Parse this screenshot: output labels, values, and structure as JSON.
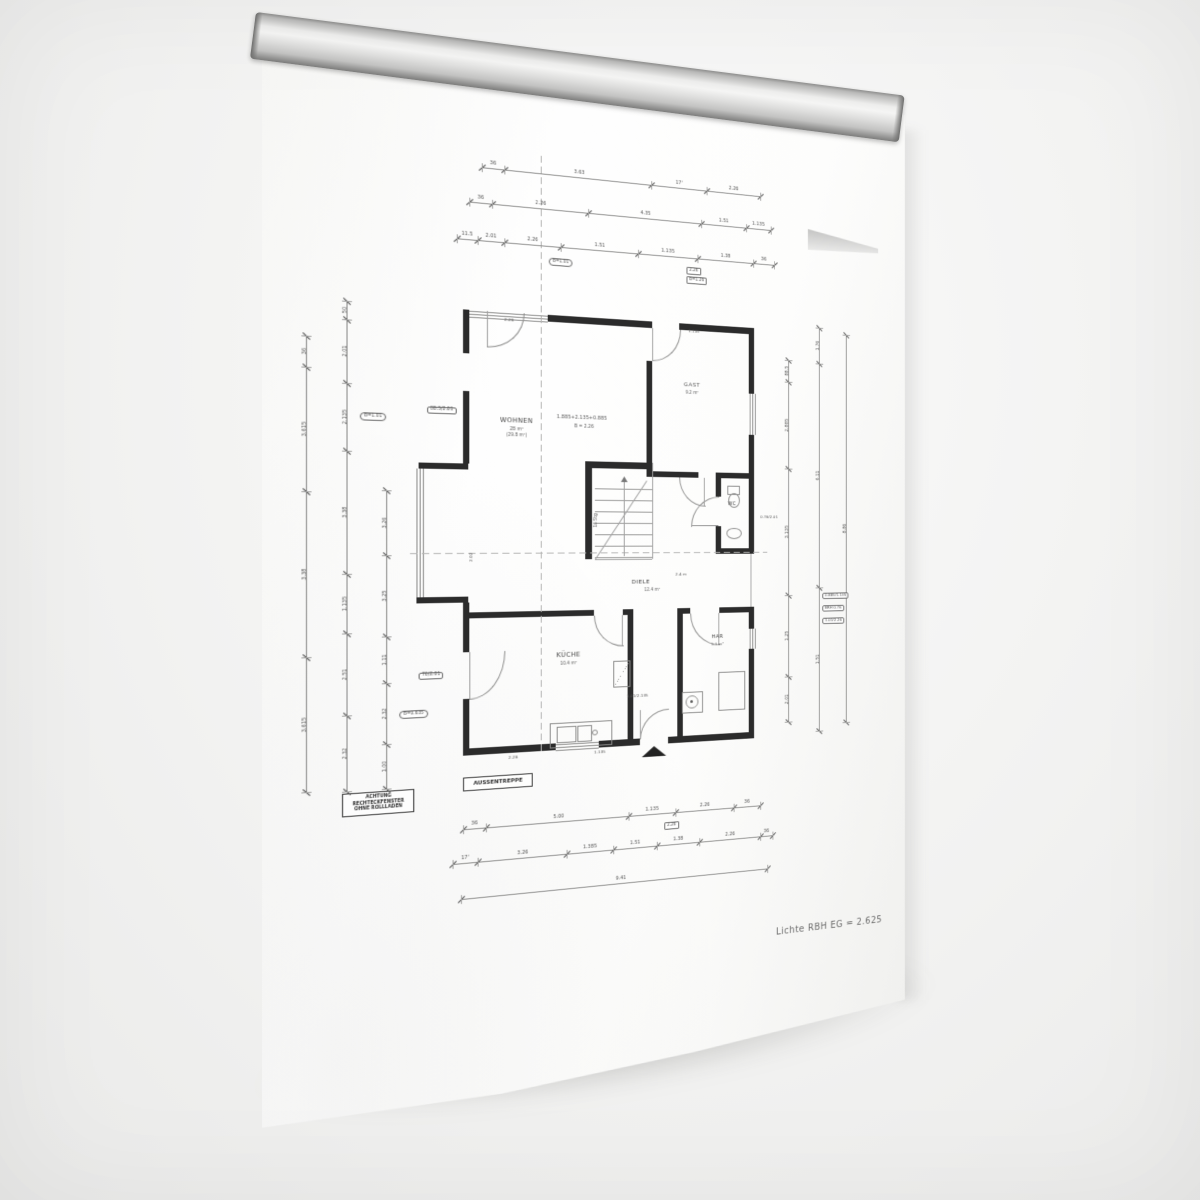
{
  "scene": {
    "description": "photo of architectural ground-floor plan sheet hanging on a wall rail",
    "background_color": "#f2f2f1",
    "paper_color": "#fdfdfc",
    "rail_color": "#d9d9d8",
    "ink_color": "#2b2b2b"
  },
  "rooms": {
    "wohnen": {
      "name": "WOHNEN",
      "area": "28 m²",
      "area2": "(29.8 m²)"
    },
    "gast": {
      "name": "GAST",
      "area": "9.2 m²"
    },
    "wc": {
      "name": "WC"
    },
    "diele": {
      "name": "DIELE",
      "area": "12.4 m²"
    },
    "kueche": {
      "name": "KÜCHE",
      "area": "10.4 m²"
    },
    "har": {
      "name": "HAR",
      "area": "5.1 m²"
    }
  },
  "notes": {
    "warning": [
      "ACHTUNG",
      "RECHTECKFENSTER",
      "OHNE ROLLLADEN"
    ],
    "box_label": "AUSSENTREPPE",
    "bottom_right": "Lichte RBH EG = 2.625"
  },
  "chains": [
    {
      "o": "h",
      "x": 38,
      "y": 148,
      "segs": [
        [
          22,
          "36"
        ],
        [
          150,
          "3.63"
        ],
        [
          60,
          "17'"
        ],
        [
          60,
          "2.26"
        ]
      ]
    },
    {
      "o": "h",
      "x": 26,
      "y": 184,
      "segs": [
        [
          22,
          "36"
        ],
        [
          96,
          "2.26"
        ],
        [
          120,
          "4.35"
        ],
        [
          50,
          "1.51"
        ],
        [
          28,
          "1.135"
        ]
      ]
    },
    {
      "o": "h",
      "x": 14,
      "y": 222,
      "segs": [
        [
          20,
          "11.5"
        ],
        [
          26,
          "2.01"
        ],
        [
          56,
          "2.26"
        ],
        [
          80,
          "1.51"
        ],
        [
          64,
          "1.135"
        ],
        [
          62,
          "1.38"
        ],
        [
          24,
          "36"
        ]
      ],
      "tags": [
        {
          "at": 102,
          "dy": 12,
          "t": "B=1.01",
          "oval": true
        },
        {
          "at": 246,
          "dy": 10,
          "t": "2.26",
          "box": true
        },
        {
          "at": 246,
          "dy": 20,
          "t": "B=1.26",
          "box": true
        }
      ]
    },
    {
      "o": "h",
      "x": 20,
      "y": 816,
      "segs": [
        [
          22,
          "36"
        ],
        [
          144,
          "5.00"
        ],
        [
          50,
          "1.135"
        ],
        [
          64,
          "2.26"
        ],
        [
          30,
          "36"
        ]
      ],
      "tags": [
        {
          "at": 216,
          "dy": 10,
          "t": "2.26",
          "box": true
        }
      ]
    },
    {
      "o": "h",
      "x": 10,
      "y": 850,
      "segs": [
        [
          24,
          "17'"
        ],
        [
          88,
          "3.26"
        ],
        [
          48,
          "1.385"
        ],
        [
          46,
          "1.51"
        ],
        [
          46,
          "1.38"
        ],
        [
          68,
          "2.26"
        ],
        [
          14,
          "36"
        ]
      ]
    },
    {
      "o": "h",
      "x": 18,
      "y": 886,
      "segs": [
        [
          320,
          "9.41"
        ]
      ]
    },
    {
      "o": "v",
      "x": -124,
      "y": 328,
      "segs": [
        [
          30,
          "36"
        ],
        [
          120,
          "3.615"
        ],
        [
          160,
          "3.38"
        ],
        [
          130,
          "3.615"
        ]
      ]
    },
    {
      "o": "v",
      "x": -88,
      "y": 292,
      "segs": [
        [
          18,
          "50"
        ],
        [
          62,
          "2.01"
        ],
        [
          66,
          "2.135"
        ],
        [
          120,
          "3.38"
        ],
        [
          58,
          "1.135"
        ],
        [
          80,
          "2.51"
        ],
        [
          74,
          "2.32"
        ]
      ],
      "tags": [
        {
          "at": 112,
          "dx": 12,
          "t": "B=1.01",
          "oval": true
        }
      ]
    },
    {
      "o": "v",
      "x": -52,
      "y": 476,
      "segs": [
        [
          64,
          "3.26"
        ],
        [
          80,
          "3.25"
        ],
        [
          46,
          "1.11"
        ],
        [
          60,
          "2.32"
        ],
        [
          44,
          "1.00"
        ]
      ],
      "tags": [
        {
          "at": 222,
          "dx": 12,
          "t": "B=0.635",
          "oval": true
        }
      ]
    },
    {
      "o": "v",
      "x": 362,
      "y": 326,
      "segs": [
        [
          24,
          "88.5"
        ],
        [
          96,
          "2.885"
        ],
        [
          140,
          "3.135"
        ],
        [
          90,
          "1.25"
        ],
        [
          50,
          "2.01"
        ]
      ]
    },
    {
      "o": "v",
      "x": 398,
      "y": 288,
      "segs": [
        [
          40,
          "1.76"
        ],
        [
          250,
          "6.11"
        ],
        [
          160,
          "1.51"
        ]
      ]
    },
    {
      "o": "v",
      "x": 430,
      "y": 294,
      "segs": [
        [
          436,
          "8.86"
        ]
      ]
    }
  ],
  "micro": [
    {
      "x": 112,
      "y": 396,
      "t": "1.885+2.135+0.885",
      "s": 5
    },
    {
      "x": 130,
      "y": 406,
      "t": "B = 2.26",
      "s": 4.5
    },
    {
      "x": -14,
      "y": 392,
      "t": "88.5/2.01",
      "s": 4.5,
      "box": true
    },
    {
      "x": -22,
      "y": 657,
      "t": "76/2.01",
      "s": 4.5,
      "box": true
    },
    {
      "x": 146,
      "y": 502,
      "t": "16 Stg",
      "s": 4.5,
      "rot": -90
    },
    {
      "x": 184,
      "y": 688,
      "t": "1.01/2.135",
      "s": 4.2
    },
    {
      "x": 402,
      "y": 584,
      "t": "0.885/1.135",
      "s": 4.2,
      "box": true
    },
    {
      "x": 402,
      "y": 598,
      "t": "BRH 0.76",
      "s": 4.2,
      "box": true
    },
    {
      "x": 402,
      "y": 612,
      "t": "1.01/2.26",
      "s": 4.2,
      "box": true
    },
    {
      "x": 330,
      "y": 498,
      "t": "0.76/2.01",
      "s": 4.2
    },
    {
      "x": 60,
      "y": 299,
      "t": "2.26",
      "s": 4.2
    },
    {
      "x": 250,
      "y": 299,
      "t": "1.135",
      "s": 4.2
    },
    {
      "x": 24,
      "y": 540,
      "t": "2.02",
      "s": 4.2,
      "rot": -90
    },
    {
      "x": 150,
      "y": 745,
      "t": "1.135",
      "s": 4.2
    },
    {
      "x": 64,
      "y": 745,
      "t": "2.26",
      "s": 4.2
    },
    {
      "x": 236,
      "y": 560,
      "t": "2.4 m",
      "s": 4.2
    }
  ]
}
